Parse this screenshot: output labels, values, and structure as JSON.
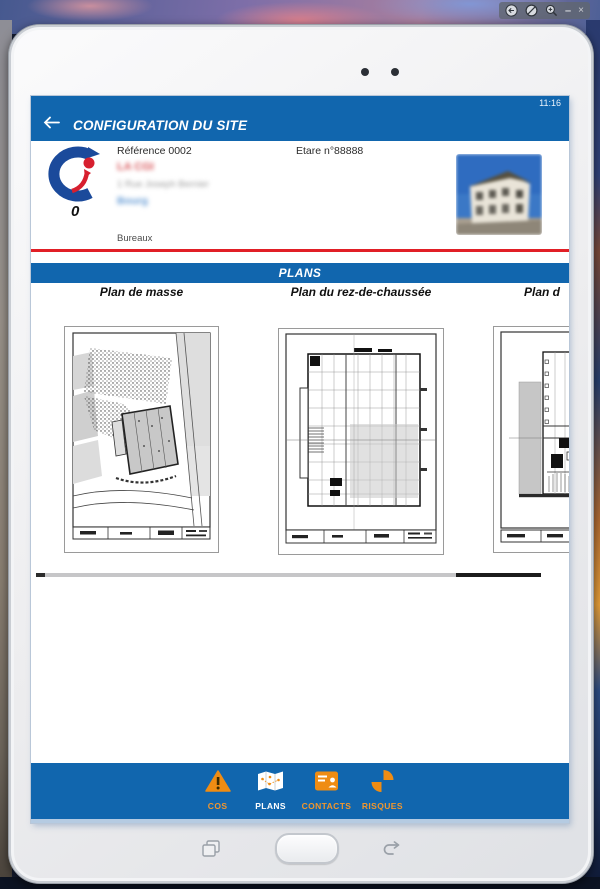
{
  "window": {
    "toolbar_icons": [
      "back-circle-icon",
      "block-icon",
      "zoom-in-icon",
      "minimize-icon",
      "close-icon"
    ],
    "minimize_glyph": "–",
    "close_glyph": "×"
  },
  "status_bar": {
    "time": "11:16"
  },
  "app_header": {
    "title": "CONFIGURATION DU SITE",
    "back_icon": "arrow-left",
    "bg_color": "#1166ae"
  },
  "site_info": {
    "reference": "Référence 0002",
    "etare": "Etare n°88888",
    "name_blurred": "LA CGI",
    "address_blurred": "1 Rue Joseph Bernier",
    "city_blurred": "Bourg",
    "logo_number": "0",
    "type_label": "Bureaux",
    "photo": "building-photo-blurred",
    "divider_color": "#e11f26"
  },
  "plans_section": {
    "banner": "PLANS",
    "items": [
      {
        "title": "Plan de masse",
        "thumbnail": "site-plan-drawing"
      },
      {
        "title": "Plan du rez-de-chaussée",
        "thumbnail": "ground-floor-plan-drawing"
      },
      {
        "title": "Plan d",
        "thumbnail": "floor-plan-drawing-cropped"
      }
    ]
  },
  "bottom_nav": {
    "bg_color": "#1166ae",
    "accent_color": "#ef8c13",
    "items": [
      {
        "label": "COS",
        "icon": "warning-triangle-icon",
        "active": false
      },
      {
        "label": "PLANS",
        "icon": "map-icon",
        "active": true
      },
      {
        "label": "CONTACTS",
        "icon": "contact-card-icon",
        "active": false
      },
      {
        "label": "RISQUES",
        "icon": "risk-quadrants-icon",
        "active": false
      }
    ]
  },
  "device": {
    "hardware_icons": [
      "recents-icon",
      "home-button",
      "back-hardware-icon"
    ],
    "camera_dots": 2
  }
}
